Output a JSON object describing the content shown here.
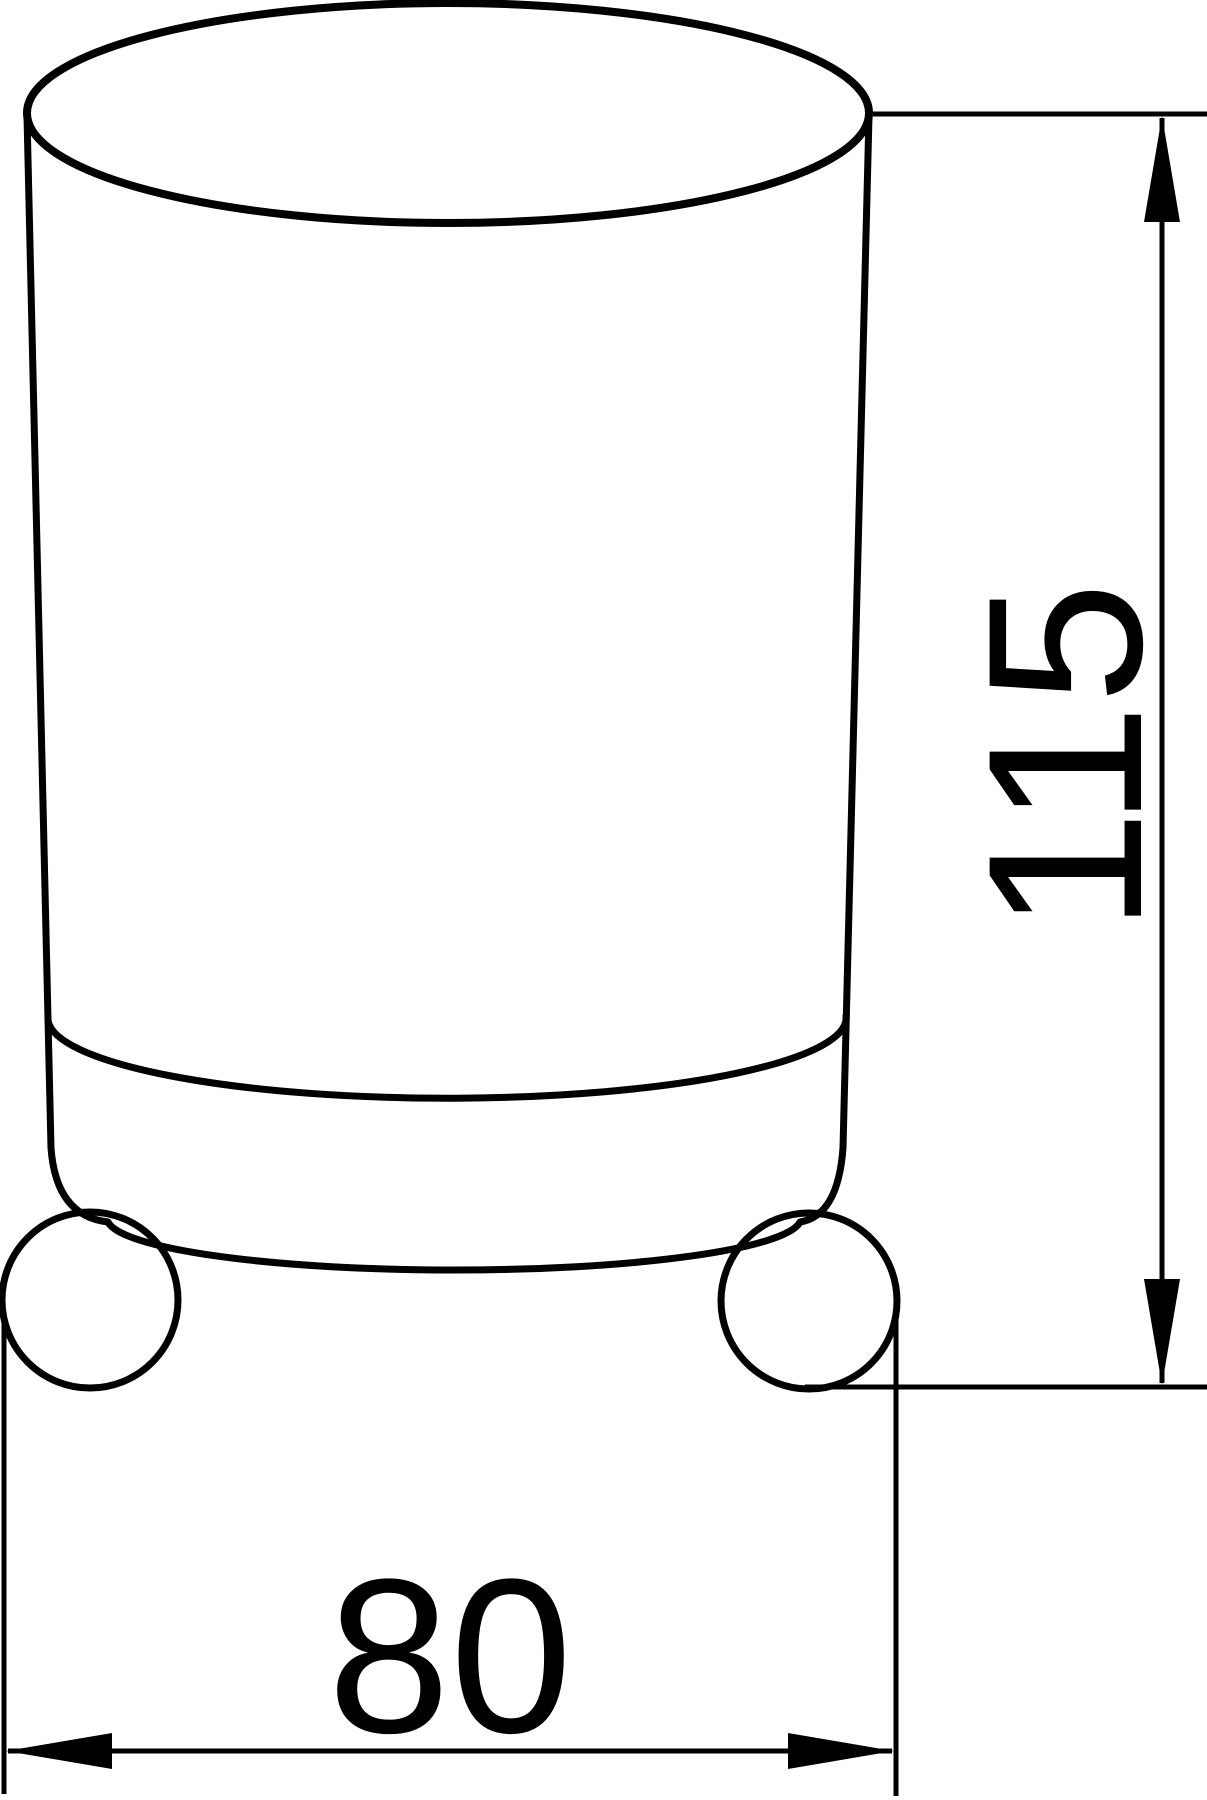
{
  "document": {
    "kind": "technical dimension drawing",
    "subject": "cylindrical tumbler resting on a holder ring with two ball supports, front view",
    "background_color": "#ffffff",
    "line_color": "#000000"
  },
  "dimensions": {
    "height": {
      "value": "115",
      "orientation": "vertical"
    },
    "width": {
      "value": "80",
      "orientation": "horizontal"
    }
  }
}
